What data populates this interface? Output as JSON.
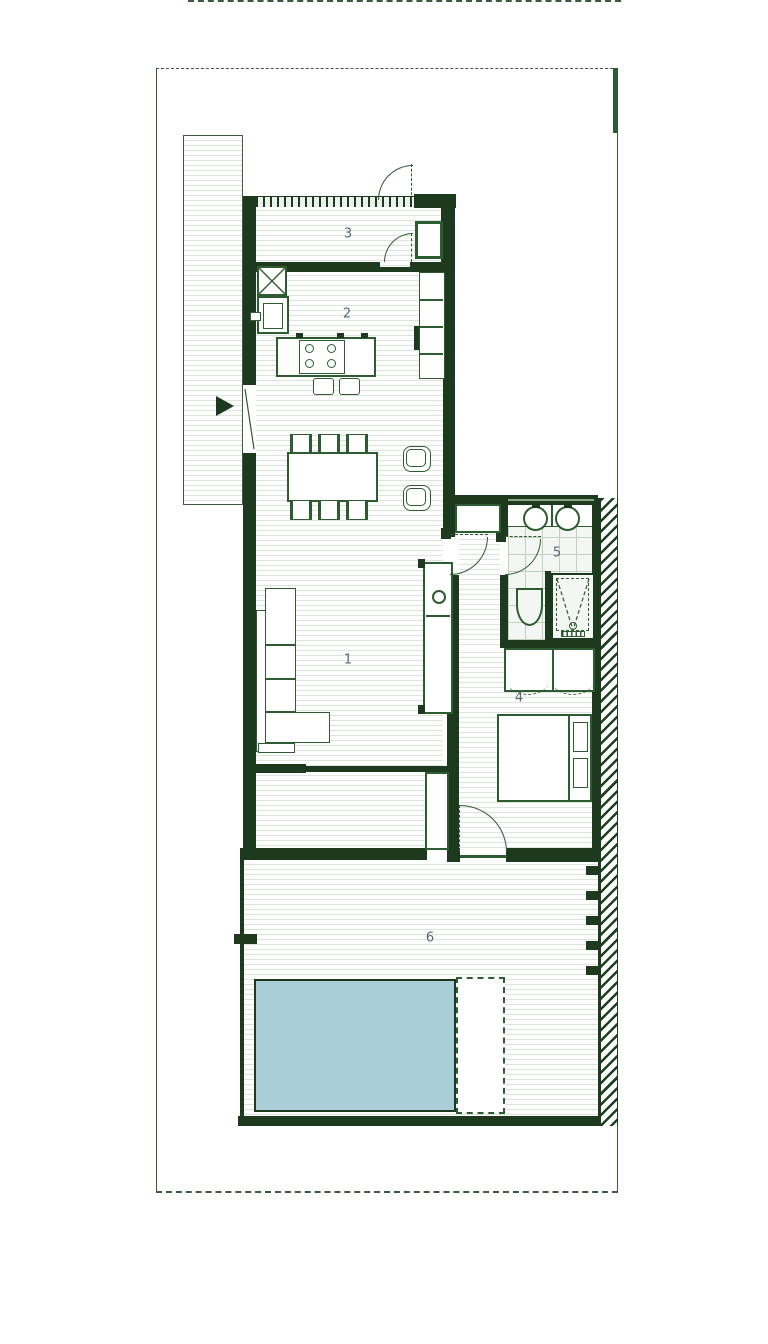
{
  "rooms": [
    {
      "number": "1"
    },
    {
      "number": "2"
    },
    {
      "number": "3"
    },
    {
      "number": "4"
    },
    {
      "number": "5"
    },
    {
      "number": "6"
    }
  ],
  "colors": {
    "wall": "#1d3a1f",
    "line": "#2e5c31",
    "boundary": "#3a5c3c",
    "label": "#5a6874",
    "pool": "#a9ced8",
    "stripe": "#dde4db",
    "tile": "#c3d1c3",
    "hatch": "#1d4021"
  }
}
